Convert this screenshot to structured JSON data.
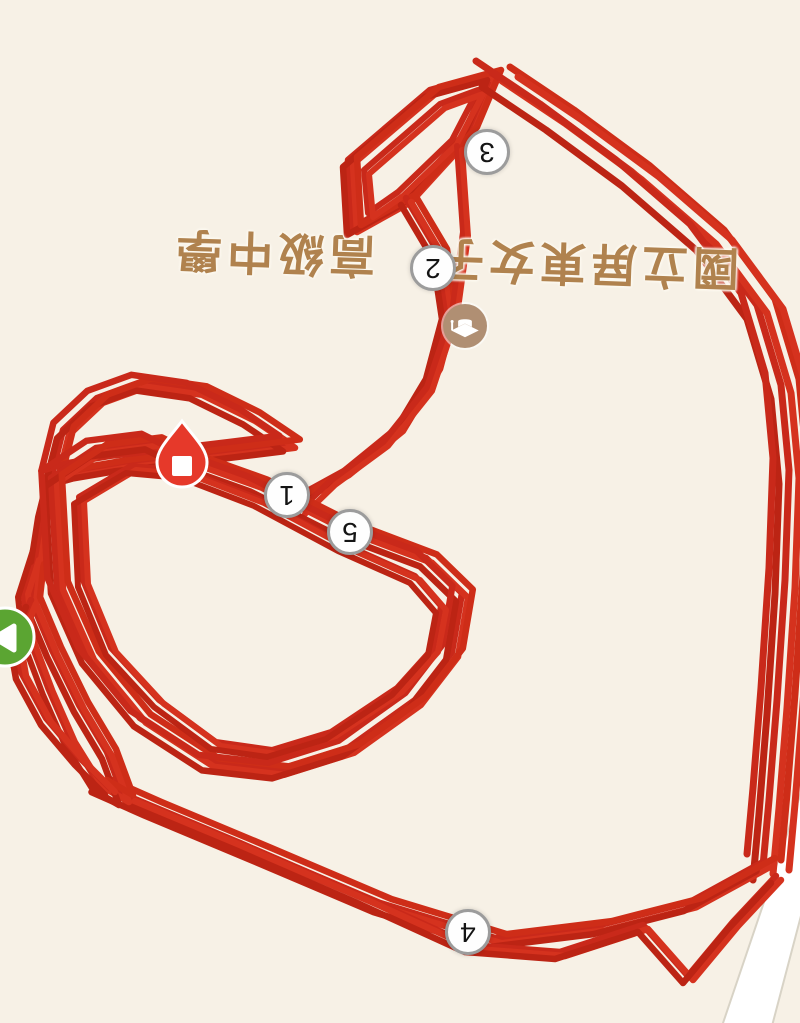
{
  "app": {
    "view": "run-route-map",
    "map_rotation_deg": 180
  },
  "map": {
    "bg_color": "#f7f1e6",
    "road": {
      "fill": "#ffffff",
      "edge_color": "#d8d3c6",
      "polygon": [
        [
          802,
          790
        ],
        [
          722,
          1026
        ],
        [
          772,
          1026
        ],
        [
          802,
          912
        ]
      ]
    },
    "poi": {
      "label_full": "國立屏東女子高級中學",
      "label_part_a": "國立屏東女子",
      "label_part_b": "高級中學",
      "label_color": "#b0824e",
      "icon": "graduation-cap-icon",
      "icon_bg": "#b08f73",
      "icon_center": {
        "x": 465,
        "y": 326
      }
    }
  },
  "track": {
    "colors": [
      "#c9291a",
      "#d5321e",
      "#bc2414",
      "#ce2d18"
    ],
    "pass_offsets": [
      [
        0,
        0
      ],
      [
        5,
        4
      ],
      [
        -5,
        7
      ],
      [
        9,
        -3
      ],
      [
        -8,
        -6
      ],
      [
        13,
        2
      ]
    ],
    "segments": [
      {
        "name": "top-triangle",
        "passes": 4,
        "width": 6.5,
        "spread": 1,
        "points": [
          [
            352,
            228
          ],
          [
            348,
            160
          ],
          [
            430,
            90
          ],
          [
            492,
            73
          ],
          [
            468,
            130
          ],
          [
            406,
            198
          ],
          [
            352,
            228
          ]
        ]
      },
      {
        "name": "top-triangle-inner",
        "passes": 2,
        "width": 6,
        "spread": 1,
        "points": [
          [
            368,
            213
          ],
          [
            364,
            170
          ],
          [
            440,
            104
          ],
          [
            478,
            90
          ],
          [
            452,
            140
          ],
          [
            398,
            192
          ],
          [
            368,
            213
          ]
        ]
      },
      {
        "name": "neck",
        "passes": 4,
        "width": 6.5,
        "spread": 1,
        "points": [
          [
            406,
            198
          ],
          [
            438,
            252
          ],
          [
            447,
            312
          ],
          [
            431,
            372
          ],
          [
            398,
            427
          ],
          [
            344,
            471
          ],
          [
            293,
            499
          ]
        ]
      },
      {
        "name": "neck-b",
        "passes": 2,
        "width": 6,
        "spread": 1,
        "points": [
          [
            457,
            146
          ],
          [
            463,
            232
          ],
          [
            452,
            312
          ],
          [
            427,
            387
          ],
          [
            383,
            442
          ],
          [
            330,
            481
          ],
          [
            300,
            510
          ]
        ]
      },
      {
        "name": "right-descent",
        "passes": 6,
        "width": 7,
        "spread": 2,
        "points": [
          [
            492,
            73
          ],
          [
            556,
            116
          ],
          [
            632,
            172
          ],
          [
            706,
            236
          ],
          [
            757,
            305
          ],
          [
            781,
            385
          ],
          [
            789,
            470
          ],
          [
            785,
            580
          ],
          [
            777,
            700
          ],
          [
            769,
            800
          ],
          [
            763,
            866
          ]
        ]
      },
      {
        "name": "bottom-a",
        "passes": 4,
        "width": 6.5,
        "spread": 1.3,
        "points": [
          [
            763,
            862
          ],
          [
            690,
            902
          ],
          [
            600,
            925
          ],
          [
            495,
            938
          ],
          [
            380,
            903
          ],
          [
            260,
            852
          ],
          [
            150,
            806
          ],
          [
            98,
            783
          ]
        ]
      },
      {
        "name": "bottom-b",
        "passes": 3,
        "width": 6.5,
        "spread": 1,
        "points": [
          [
            776,
            876
          ],
          [
            733,
            922
          ],
          [
            688,
            976
          ],
          [
            643,
            925
          ],
          [
            560,
            952
          ],
          [
            470,
            945
          ],
          [
            360,
            895
          ],
          [
            240,
            843
          ],
          [
            130,
            797
          ]
        ]
      },
      {
        "name": "corner-loop",
        "passes": 4,
        "width": 6.5,
        "spread": 1,
        "points": [
          [
            98,
            783
          ],
          [
            124,
            798
          ],
          [
            107,
            752
          ],
          [
            79,
            705
          ],
          [
            52,
            650
          ],
          [
            31,
            600
          ],
          [
            36,
            555
          ]
        ]
      },
      {
        "name": "corner-loop-b",
        "passes": 3,
        "width": 6,
        "spread": 1,
        "points": [
          [
            98,
            783
          ],
          [
            70,
            738
          ],
          [
            48,
            688
          ],
          [
            28,
            635
          ],
          [
            23,
            590
          ],
          [
            39,
            540
          ]
        ]
      },
      {
        "name": "left-edge",
        "passes": 3,
        "width": 6.5,
        "spread": 1,
        "points": [
          [
            31,
            600
          ],
          [
            15,
            638
          ],
          [
            21,
            672
          ],
          [
            46,
            718
          ],
          [
            80,
            758
          ],
          [
            110,
            788
          ]
        ]
      },
      {
        "name": "left-rise",
        "passes": 3,
        "width": 6,
        "spread": 1,
        "points": [
          [
            36,
            555
          ],
          [
            43,
            510
          ],
          [
            51,
            478
          ]
        ]
      },
      {
        "name": "upper-left-blob",
        "passes": 5,
        "width": 6.5,
        "spread": 1.2,
        "points": [
          [
            51,
            478
          ],
          [
            63,
            430
          ],
          [
            97,
            398
          ],
          [
            141,
            382
          ],
          [
            196,
            390
          ],
          [
            249,
            416
          ],
          [
            289,
            443
          ],
          [
            240,
            449
          ],
          [
            182,
            456
          ],
          [
            120,
            463
          ],
          [
            79,
            470
          ],
          [
            51,
            478
          ]
        ]
      },
      {
        "name": "inner-loop-outer",
        "passes": 5,
        "width": 6.5,
        "spread": 1.2,
        "points": [
          [
            51,
            478
          ],
          [
            96,
            448
          ],
          [
            151,
            441
          ],
          [
            183,
            457
          ],
          [
            256,
            483
          ],
          [
            341,
            526
          ],
          [
            426,
            558
          ],
          [
            462,
            593
          ],
          [
            452,
            652
          ],
          [
            415,
            700
          ],
          [
            348,
            748
          ],
          [
            278,
            770
          ],
          [
            208,
            762
          ],
          [
            140,
            718
          ],
          [
            88,
            655
          ],
          [
            57,
            585
          ],
          [
            51,
            478
          ]
        ]
      },
      {
        "name": "inner-loop-inner",
        "passes": 3,
        "width": 6,
        "spread": 1,
        "points": [
          [
            79,
            497
          ],
          [
            131,
            466
          ],
          [
            186,
            471
          ],
          [
            259,
            499
          ],
          [
            343,
            544
          ],
          [
            415,
            576
          ],
          [
            441,
            606
          ],
          [
            433,
            648
          ],
          [
            397,
            688
          ],
          [
            331,
            732
          ],
          [
            272,
            750
          ],
          [
            216,
            742
          ],
          [
            159,
            700
          ],
          [
            111,
            648
          ],
          [
            83,
            580
          ],
          [
            79,
            497
          ]
        ]
      }
    ]
  },
  "markers": {
    "km": [
      {
        "label": "3",
        "x": 487,
        "y": 152
      },
      {
        "label": "2",
        "x": 433,
        "y": 268
      },
      {
        "label": "1",
        "x": 287,
        "y": 495
      },
      {
        "label": "5",
        "x": 350,
        "y": 532
      },
      {
        "label": "4",
        "x": 468,
        "y": 932
      }
    ],
    "km_style": {
      "bg": "#fefefe",
      "border": "#9c9c9c",
      "text": "#141414"
    },
    "start": {
      "x": 5,
      "y": 637,
      "color": "#5ba532",
      "glyph": "play-triangle"
    },
    "finish": {
      "x": 182,
      "y": 462,
      "color": "#e6392a",
      "glyph": "stop-square"
    }
  }
}
